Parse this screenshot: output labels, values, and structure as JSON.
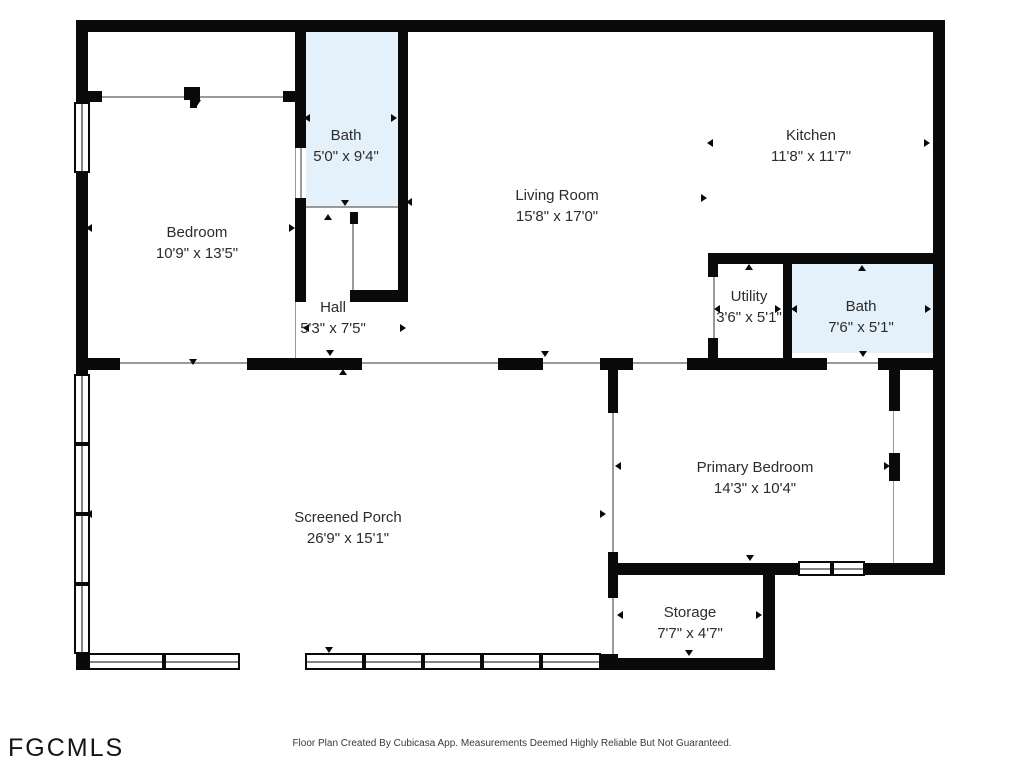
{
  "floorplan": {
    "watermark": "FGCMLS",
    "footer": "Floor Plan Created By Cubicasa App. Measurements Deemed Highly Reliable But Not Guaranteed.",
    "colors": {
      "wall": "#0a0a0a",
      "bath_fill": "#e4f0fa",
      "label_text": "#2c2c2c",
      "thin_line": "#9a9a9a"
    },
    "rooms": [
      {
        "name": "Bedroom",
        "dims": "10'9\" x 13'5\""
      },
      {
        "name": "Bath",
        "dims": "5'0\" x 9'4\""
      },
      {
        "name": "Hall",
        "dims": "5'3\" x 7'5\""
      },
      {
        "name": "Living Room",
        "dims": "15'8\" x 17'0\""
      },
      {
        "name": "Kitchen",
        "dims": "11'8\" x 11'7\""
      },
      {
        "name": "Utility",
        "dims": "3'6\" x 5'1\""
      },
      {
        "name": "Bath",
        "dims": "7'6\" x 5'1\""
      },
      {
        "name": "Primary Bedroom",
        "dims": "14'3\" x 10'4\""
      },
      {
        "name": "Storage",
        "dims": "7'7\" x 4'7\""
      },
      {
        "name": "Screened Porch",
        "dims": "26'9\" x 15'1\""
      }
    ],
    "markers": [
      {
        "d": "up",
        "x": 345,
        "y": 27
      },
      {
        "d": "up",
        "x": 557,
        "y": 28
      },
      {
        "d": "up",
        "x": 820,
        "y": 28
      },
      {
        "d": "down",
        "x": 197,
        "y": 103
      },
      {
        "d": "left",
        "x": 308,
        "y": 117
      },
      {
        "d": "right",
        "x": 395,
        "y": 117
      },
      {
        "d": "left",
        "x": 90,
        "y": 227
      },
      {
        "d": "right",
        "x": 293,
        "y": 227
      },
      {
        "d": "left",
        "x": 711,
        "y": 142
      },
      {
        "d": "right",
        "x": 928,
        "y": 142
      },
      {
        "d": "left",
        "x": 410,
        "y": 201
      },
      {
        "d": "right",
        "x": 705,
        "y": 197
      },
      {
        "d": "down",
        "x": 345,
        "y": 203
      },
      {
        "d": "up",
        "x": 328,
        "y": 217
      },
      {
        "d": "left",
        "x": 307,
        "y": 327
      },
      {
        "d": "right",
        "x": 404,
        "y": 327
      },
      {
        "d": "down",
        "x": 822,
        "y": 256
      },
      {
        "d": "up",
        "x": 749,
        "y": 267
      },
      {
        "d": "up",
        "x": 862,
        "y": 268
      },
      {
        "d": "left",
        "x": 718,
        "y": 308
      },
      {
        "d": "right",
        "x": 779,
        "y": 308
      },
      {
        "d": "left",
        "x": 795,
        "y": 308
      },
      {
        "d": "right",
        "x": 929,
        "y": 308
      },
      {
        "d": "down",
        "x": 863,
        "y": 354
      },
      {
        "d": "down",
        "x": 330,
        "y": 353
      },
      {
        "d": "down",
        "x": 545,
        "y": 354
      },
      {
        "d": "down",
        "x": 193,
        "y": 362
      },
      {
        "d": "up",
        "x": 755,
        "y": 366
      },
      {
        "d": "up",
        "x": 343,
        "y": 372
      },
      {
        "d": "left",
        "x": 619,
        "y": 465
      },
      {
        "d": "right",
        "x": 888,
        "y": 465
      },
      {
        "d": "left",
        "x": 90,
        "y": 513
      },
      {
        "d": "right",
        "x": 604,
        "y": 513
      },
      {
        "d": "down",
        "x": 750,
        "y": 558
      },
      {
        "d": "up",
        "x": 689,
        "y": 572
      },
      {
        "d": "left",
        "x": 621,
        "y": 614
      },
      {
        "d": "right",
        "x": 760,
        "y": 614
      },
      {
        "d": "down",
        "x": 689,
        "y": 653
      },
      {
        "d": "down",
        "x": 329,
        "y": 650
      }
    ]
  }
}
